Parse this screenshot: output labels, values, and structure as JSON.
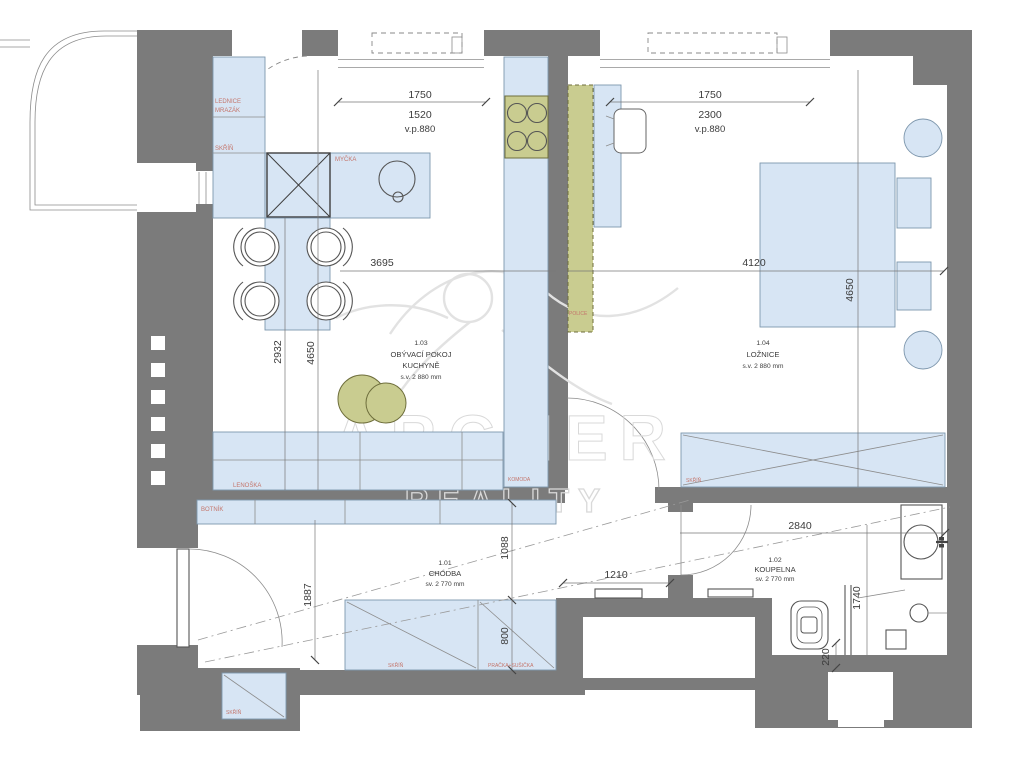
{
  "watermark": {
    "brand": "ARCHER",
    "sub": "REALITY"
  },
  "rooms": [
    {
      "num": "1.01",
      "name": "CHODBA",
      "sub": "sv. 2 770 mm"
    },
    {
      "num": "1.02",
      "name": "KOUPELNA",
      "sub": "sv. 2 770 mm"
    },
    {
      "num": "1.03",
      "name": "OBÝVACÍ POKOJ",
      "name2": "KUCHYNĚ",
      "sub": "s.v. 2 880 mm"
    },
    {
      "num": "1.04",
      "name": "LOŽNICE",
      "sub": "s.v. 2 880 mm"
    }
  ],
  "labels": {
    "lednice": "LEDNICE",
    "mrazak": "MRAZÁK",
    "skrin_kitchen": "SKŘÍŇ",
    "mycka": "MYČKA",
    "lenoska": "LENOŠKA",
    "botnik": "BOTNÍK",
    "komoda": "KOMODA",
    "police": "POLICE",
    "skrin_hall": "SKŘÍŇ",
    "pracka": "PRAČKA+SUŠIČKA",
    "skrin_entry": "SKŘÍŇ",
    "skrin_bedroom": "SKŘÍŇ"
  },
  "dims": {
    "win_left": [
      "1750",
      "1520",
      "v.p.880"
    ],
    "win_right": [
      "1750",
      "2300",
      "v.p.880"
    ],
    "living_width": "3695",
    "bedroom_width": "4120",
    "bedroom_depth": "4650",
    "living_depth_a": "2932",
    "living_depth_b": "4650",
    "hallway_length": "1887",
    "hallway_width": "1088",
    "hall_wardrobe_depth": "800",
    "hall_passage": "1210",
    "bathroom_width": "2840",
    "shower_length": "1740",
    "gap_220": "220"
  }
}
